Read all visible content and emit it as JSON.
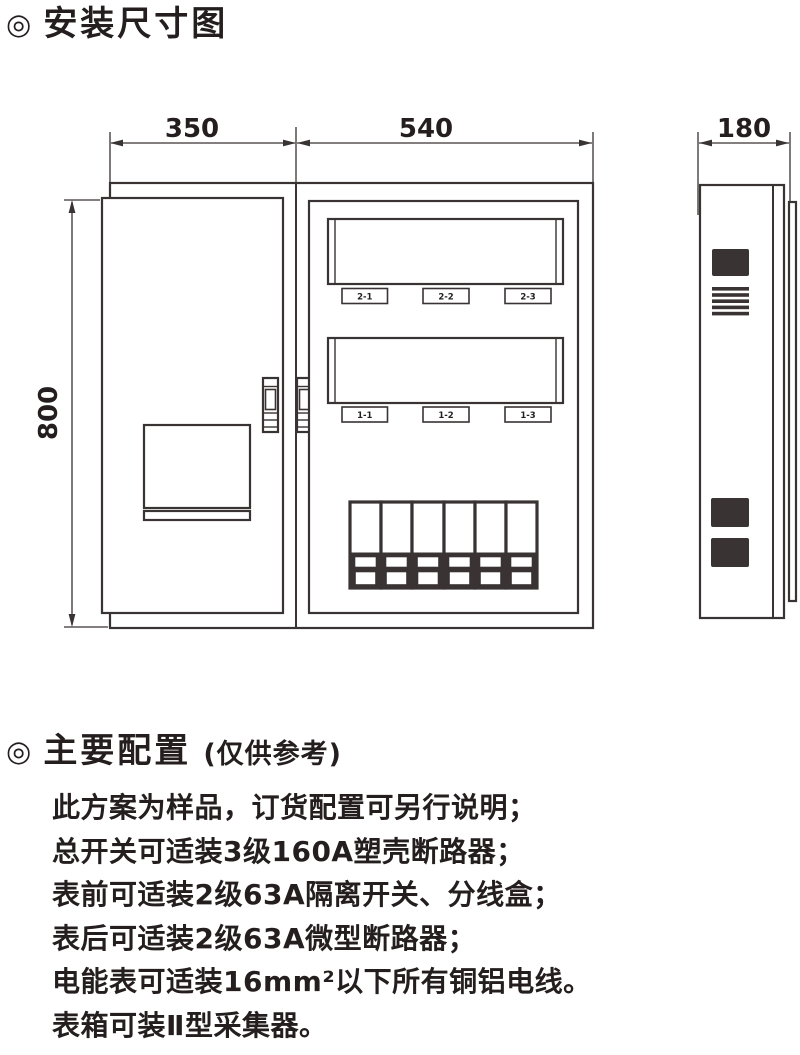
{
  "colors": {
    "ink": "#3a3333",
    "text": "#241e1e",
    "background": "#ffffff"
  },
  "sections": {
    "install_title": {
      "bullet": "◎",
      "title": "安装尺寸图"
    },
    "config_title": {
      "bullet": "◎",
      "title": "主要配置",
      "note": "(仅供参考)"
    }
  },
  "drawing": {
    "dimensions": {
      "front_left": "350",
      "front_right": "540",
      "side_depth": "180",
      "height": "800"
    },
    "meter_labels": [
      "2-1",
      "2-2",
      "2-3",
      "1-1",
      "1-2",
      "1-3"
    ]
  },
  "notes": {
    "lines": [
      "此方案为样品，订货配置可另行说明；",
      "总开关可适装3级160A塑壳断路器；",
      "表前可适装2级63A隔离开关、分线盒；",
      "表后可适装2级63A微型断路器；",
      "电能表可适装16mm²以下所有铜铝电线。",
      "表箱可装Ⅱ型采集器。"
    ]
  }
}
